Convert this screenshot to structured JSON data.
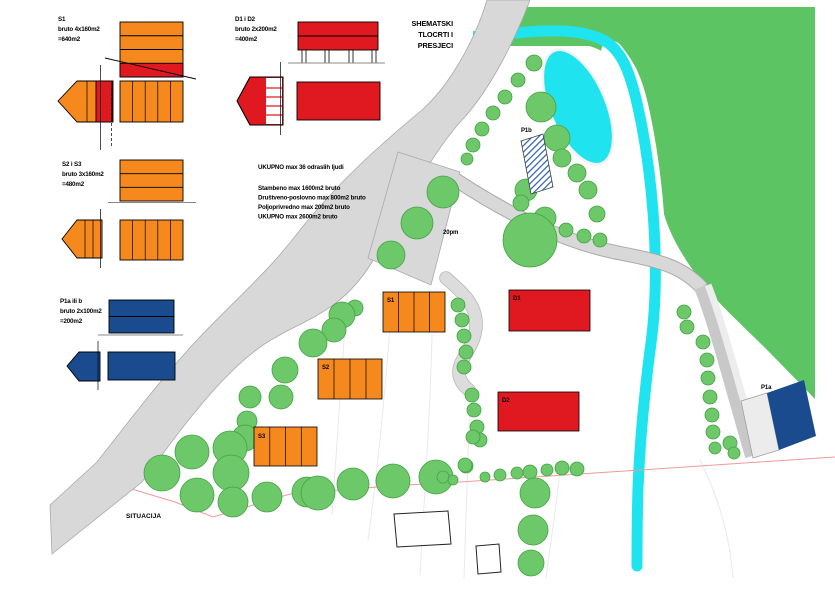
{
  "title": {
    "line1": "SHEMATSKI",
    "line2": "TLOCRTI I",
    "line3": "PRESJECI"
  },
  "legend": {
    "s1": {
      "name": "S1",
      "area": "bruto 4x160m2",
      "total": "=640m2"
    },
    "d": {
      "name": "D1 i D2",
      "area": "bruto 2x200m2",
      "total": "=400m2"
    },
    "s23": {
      "name": "S2 i S3",
      "area": "bruto 3x160m2",
      "total": "=480m2"
    },
    "p": {
      "name": "P1a ili b",
      "area": "bruto 2x100m2",
      "total": "=200m2"
    }
  },
  "program": {
    "line1": "UKUPNO max 36 odraslih ljudi",
    "line2": "Stambeno max 1600m2 bruto",
    "line3": "Društveno-poslovno max 800m2 bruto",
    "line4": "Poljoprivredno max 200m2 bruto",
    "line5": "UKUPNO max 2600m2 bruto"
  },
  "map": {
    "caption": "SITUACIJA",
    "parking_label": "20pm",
    "labels": {
      "s1": "S1",
      "s2": "S2",
      "s3": "S3",
      "d1": "D1",
      "d2": "D2",
      "p1a": "P1a",
      "p1b": "P1b"
    }
  },
  "colors": {
    "orange": "#F6891E",
    "red": "#E01920",
    "blue": "#1A4B8F",
    "treeFill": "#6CC868",
    "treeStroke": "#44A244",
    "forest": "#5CC463",
    "water": "#1FE4EF",
    "roadFill": "#D8D8D8",
    "roadEdge": "#A9A9A9",
    "pathLight": "#DCDCDC",
    "pathEdge": "#B5B5B5",
    "boundary": "#F09A9A",
    "hatch": "#2A5FA8",
    "lightBuilding": "#ECECEC",
    "faint": "#E9E9E9"
  },
  "trees": [
    [
      534,
      63,
      8
    ],
    [
      518,
      80,
      7
    ],
    [
      505,
      97,
      7
    ],
    [
      493,
      113,
      7
    ],
    [
      482,
      129,
      7
    ],
    [
      473,
      145,
      7
    ],
    [
      467,
      159,
      6
    ],
    [
      541,
      107,
      15
    ],
    [
      557,
      138,
      13
    ],
    [
      526,
      190,
      11
    ],
    [
      562,
      158,
      9
    ],
    [
      577,
      173,
      9
    ],
    [
      588,
      190,
      9
    ],
    [
      597,
      214,
      8
    ],
    [
      521,
      203,
      8
    ],
    [
      545,
      218,
      11
    ],
    [
      566,
      230,
      7
    ],
    [
      584,
      236,
      7
    ],
    [
      600,
      240,
      7
    ],
    [
      530,
      240,
      27
    ],
    [
      443,
      192,
      16
    ],
    [
      417,
      223,
      16
    ],
    [
      391,
      255,
      14
    ],
    [
      355,
      308,
      8
    ],
    [
      458,
      305,
      7
    ],
    [
      462,
      320,
      7
    ],
    [
      464,
      336,
      7
    ],
    [
      466,
      352,
      7
    ],
    [
      464,
      367,
      7
    ],
    [
      472,
      395,
      7
    ],
    [
      474,
      410,
      7
    ],
    [
      477,
      427,
      7
    ],
    [
      480,
      440,
      7
    ],
    [
      466,
      466,
      7
    ],
    [
      342,
      315,
      13
    ],
    [
      334,
      330,
      12
    ],
    [
      313,
      343,
      14
    ],
    [
      285,
      370,
      13
    ],
    [
      281,
      397,
      12
    ],
    [
      250,
      397,
      11
    ],
    [
      247,
      421,
      10
    ],
    [
      245,
      438,
      13
    ],
    [
      192,
      452,
      17
    ],
    [
      230,
      448,
      17
    ],
    [
      162,
      473,
      18
    ],
    [
      231,
      473,
      18
    ],
    [
      197,
      495,
      17
    ],
    [
      233,
      502,
      15
    ],
    [
      267,
      497,
      15
    ],
    [
      307,
      492,
      15
    ],
    [
      318,
      493,
      17
    ],
    [
      353,
      484,
      16
    ],
    [
      393,
      481,
      17
    ],
    [
      436,
      477,
      17
    ],
    [
      443,
      477,
      6
    ],
    [
      453,
      480,
      5
    ],
    [
      465,
      465,
      7
    ],
    [
      473,
      437,
      7
    ],
    [
      485,
      477,
      5
    ],
    [
      500,
      475,
      6
    ],
    [
      517,
      473,
      6
    ],
    [
      530,
      472,
      7
    ],
    [
      547,
      470,
      6
    ],
    [
      562,
      468,
      7
    ],
    [
      577,
      469,
      7
    ],
    [
      535,
      493,
      15
    ],
    [
      533,
      530,
      15
    ],
    [
      531,
      563,
      13
    ],
    [
      684,
      312,
      7
    ],
    [
      687,
      327,
      7
    ],
    [
      703,
      342,
      7
    ],
    [
      707,
      360,
      7
    ],
    [
      708,
      378,
      7
    ],
    [
      710,
      397,
      7
    ],
    [
      712,
      415,
      7
    ],
    [
      713,
      432,
      7
    ],
    [
      715,
      448,
      6
    ],
    [
      730,
      443,
      7
    ],
    [
      734,
      453,
      6
    ]
  ]
}
